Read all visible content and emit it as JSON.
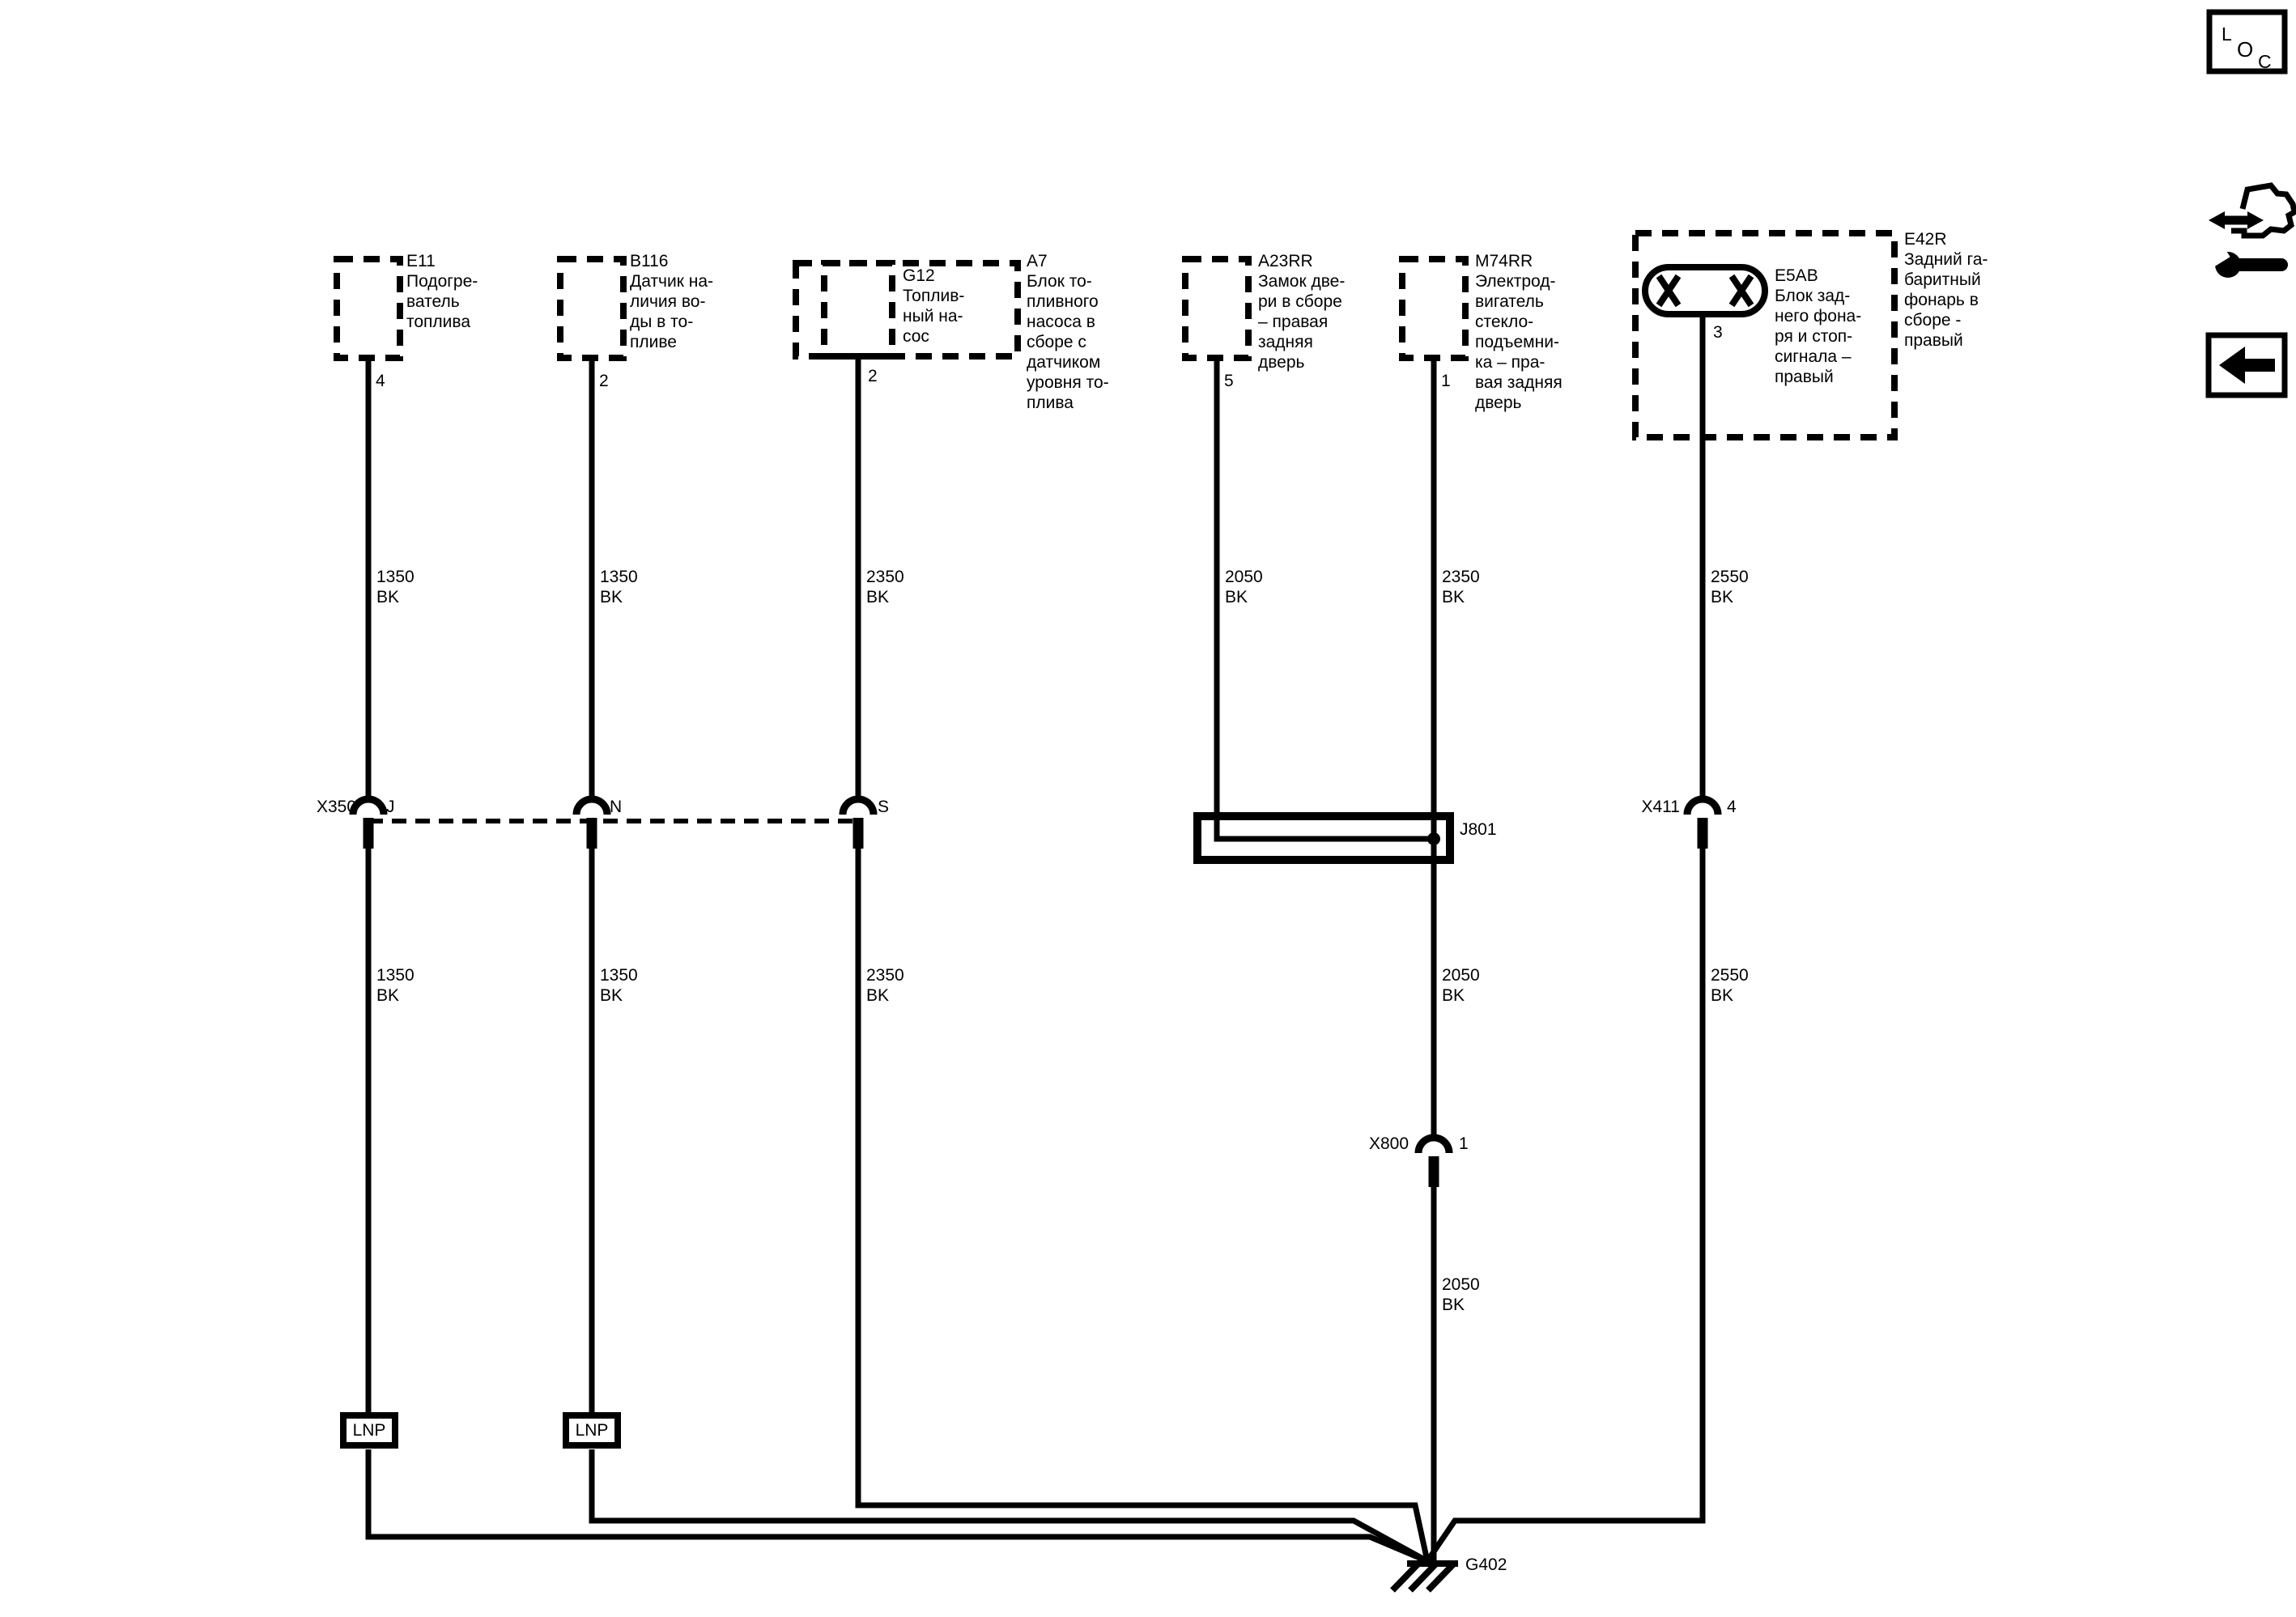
{
  "colors": {
    "line": "#000000",
    "background": "#ffffff"
  },
  "diagram": {
    "components": [
      {
        "id": "E11",
        "desc": "Подогре-\nватель\nтоплива",
        "pin": "4"
      },
      {
        "id": "B116",
        "desc": "Датчик на-\nличия во-\nды в то-\nпливе",
        "pin": "2"
      },
      {
        "id": "G12",
        "desc": "Топлив-\nный на-\nсос",
        "pin": "2"
      },
      {
        "id": "A7",
        "desc": "Блок то-\nпливного\nнасоса в\nсборе с\nдатчиком\nуровня то-\nплива"
      },
      {
        "id": "A23RR",
        "desc": "Замок две-\nри в сборе\n– правая\nзадняя\nдверь",
        "pin": "5"
      },
      {
        "id": "M74RR",
        "desc": "Электрод-\nвигатель\nстекло-\nподъемни-\nка – пра-\nвая задняя\nдверь",
        "pin": "1"
      },
      {
        "id": "E5AB",
        "desc": "Блок зад-\nнего фона-\nря и стоп-\nсигнала –\nправый",
        "pin": "3"
      },
      {
        "id": "E42R",
        "desc": "Задний га-\nбаритный\nфонарь в\nсборе -\nправый"
      }
    ],
    "connectors": {
      "x350": {
        "id": "X350",
        "pins": [
          "J",
          "N",
          "S"
        ]
      },
      "x411": {
        "id": "X411",
        "pin": "4"
      },
      "x800": {
        "id": "X800",
        "pin": "1"
      }
    },
    "splices": {
      "j801": "J801"
    },
    "grounds": {
      "g402": "G402"
    },
    "inline_labels": {
      "lnp1": "LNP",
      "lnp2": "LNP"
    },
    "wire_labels": {
      "upper": [
        "1350\nBK",
        "1350\nBK",
        "2350\nBK",
        "2050\nBK",
        "2350\nBK",
        "2550\nBK"
      ],
      "lower": [
        "1350\nBK",
        "1350\nBK",
        "2350\nBK",
        "2050\nBK",
        "2550\nBK"
      ],
      "below_x800": "2050\nBK"
    },
    "icons": {
      "loc": {
        "l": "L",
        "o": "O",
        "c": "C"
      }
    }
  }
}
